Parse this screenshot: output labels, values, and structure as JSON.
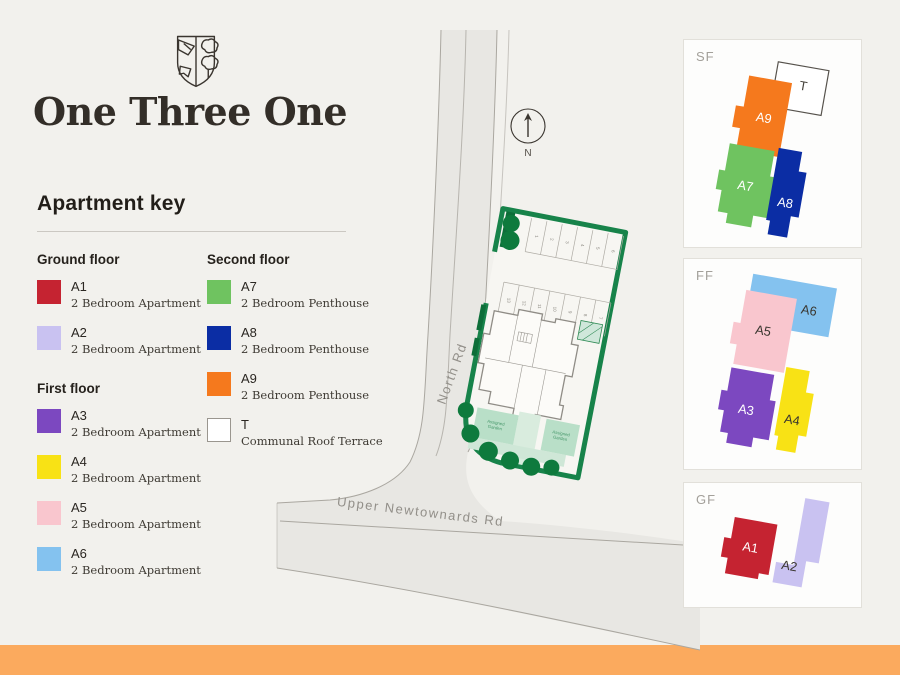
{
  "brand": {
    "title": "One Three One"
  },
  "legend": {
    "heading": "Apartment key",
    "groups": [
      {
        "title": "Ground floor"
      },
      {
        "title": "First floor"
      },
      {
        "title": "Second floor"
      }
    ]
  },
  "units": {
    "A1": {
      "code": "A1",
      "desc": "2 Bedroom Apartment",
      "color": "#c52331",
      "label_color": "#ffffff"
    },
    "A2": {
      "code": "A2",
      "desc": "2 Bedroom Apartment",
      "color": "#c9c2f1",
      "label_color": "#3a362f"
    },
    "A3": {
      "code": "A3",
      "desc": "2 Bedroom Apartment",
      "color": "#7c48c0",
      "label_color": "#ffffff"
    },
    "A4": {
      "code": "A4",
      "desc": "2 Bedroom Apartment",
      "color": "#f8e215",
      "label_color": "#3a362f"
    },
    "A5": {
      "code": "A5",
      "desc": "2 Bedroom Apartment",
      "color": "#f9c6ce",
      "label_color": "#3a362f"
    },
    "A6": {
      "code": "A6",
      "desc": "2 Bedroom Apartment",
      "color": "#84c2ef",
      "label_color": "#3a362f"
    },
    "A7": {
      "code": "A7",
      "desc": "2 Bedroom Penthouse",
      "color": "#6fc360",
      "label_color": "#ffffff"
    },
    "A8": {
      "code": "A8",
      "desc": "2 Bedroom Penthouse",
      "color": "#0b2da4",
      "label_color": "#ffffff"
    },
    "A9": {
      "code": "A9",
      "desc": "2 Bedroom Penthouse",
      "color": "#f5791d",
      "label_color": "#ffffff"
    },
    "T": {
      "code": "T",
      "desc": "Communal Roof Terrace",
      "color": "#ffffff",
      "label_color": "#45413a",
      "outline": "#56524c",
      "swatch_border": "#9a968f"
    }
  },
  "map": {
    "roads": [
      {
        "name": "North Rd"
      },
      {
        "name": "Upper Newtownards Rd"
      }
    ],
    "compass_label": "N",
    "parking_top": [
      "1",
      "2",
      "3",
      "4",
      "5",
      "6"
    ],
    "parking_mid": [
      "13",
      "12",
      "11",
      "10",
      "9",
      "8",
      "7"
    ],
    "garden_label": [
      "Assigned",
      "Garden"
    ]
  },
  "floor_panels": [
    {
      "label": "SF"
    },
    {
      "label": "FF"
    },
    {
      "label": "GF"
    }
  ],
  "colors": {
    "background": "#f2f1ed",
    "accent_bar": "#fbaa5e",
    "road_fill": "#e8e7e3",
    "road_line": "#aaa7a0",
    "hedge_green": "#17834a",
    "tree_green": "#0e7a3d",
    "garden_green": "#b9dfc8",
    "text_gray": "#a3a09a"
  }
}
